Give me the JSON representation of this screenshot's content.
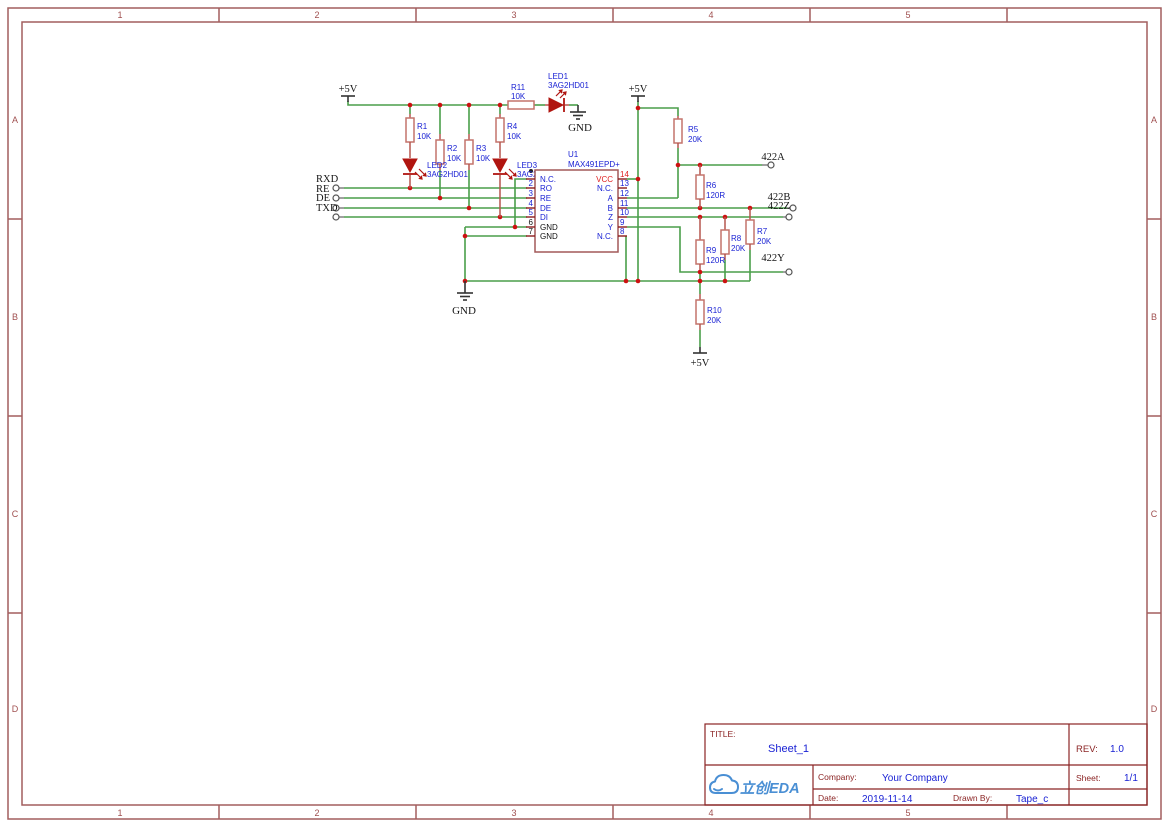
{
  "frame": {
    "columns": [
      "1",
      "2",
      "3",
      "4",
      "5"
    ],
    "rows": [
      "A",
      "B",
      "C",
      "D"
    ]
  },
  "schematic": {
    "power": {
      "vcc": "+5V",
      "gnd": "GND"
    },
    "ports": {
      "rxd": "RXD",
      "re": "RE",
      "de": "DE",
      "txd": "TXD",
      "p422a": "422A",
      "p422b": "422B",
      "p422z": "422Z",
      "p422y": "422Y"
    },
    "resistors": {
      "r1": {
        "ref": "R1",
        "value": "10K"
      },
      "r2": {
        "ref": "R2",
        "value": "10K"
      },
      "r3": {
        "ref": "R3",
        "value": "10K"
      },
      "r4": {
        "ref": "R4",
        "value": "10K"
      },
      "r5": {
        "ref": "R5",
        "value": "20K"
      },
      "r6": {
        "ref": "R6",
        "value": "120R"
      },
      "r7": {
        "ref": "R7",
        "value": "20K"
      },
      "r8": {
        "ref": "R8",
        "value": "20K"
      },
      "r9": {
        "ref": "R9",
        "value": "120R"
      },
      "r10": {
        "ref": "R10",
        "value": "20K"
      },
      "r11": {
        "ref": "R11",
        "value": "10K"
      }
    },
    "leds": {
      "led1": {
        "ref": "LED1",
        "part": "3AG2HD01"
      },
      "led2": {
        "ref": "LED2",
        "part": "3AG2HD01"
      },
      "led3": {
        "ref": "LED3",
        "part": "3AG2HD01"
      }
    },
    "ic": {
      "ref": "U1",
      "part": "MAX491EPD+",
      "pins_left": [
        {
          "num": "",
          "name": "N.C."
        },
        {
          "num": "2",
          "name": "RO"
        },
        {
          "num": "3",
          "name": "RE"
        },
        {
          "num": "4",
          "name": "DE"
        },
        {
          "num": "5",
          "name": "DI"
        },
        {
          "num": "6",
          "name": "GND"
        },
        {
          "num": "7",
          "name": "GND"
        }
      ],
      "pins_right": [
        {
          "num": "14",
          "name": "VCC"
        },
        {
          "num": "13",
          "name": "N.C."
        },
        {
          "num": "12",
          "name": "A"
        },
        {
          "num": "11",
          "name": "B"
        },
        {
          "num": "10",
          "name": "Z"
        },
        {
          "num": "9",
          "name": "Y"
        },
        {
          "num": "8",
          "name": "N.C."
        }
      ]
    }
  },
  "title_block": {
    "title_label": "TITLE:",
    "title": "Sheet_1",
    "rev_label": "REV:",
    "rev": "1.0",
    "company_label": "Company:",
    "company": "Your Company",
    "sheet_label": "Sheet:",
    "sheet": "1/1",
    "date_label": "Date:",
    "date": "2019-11-14",
    "drawn_by_label": "Drawn By:",
    "drawn_by": "Tape_c",
    "logo_text": "立创EDA"
  }
}
